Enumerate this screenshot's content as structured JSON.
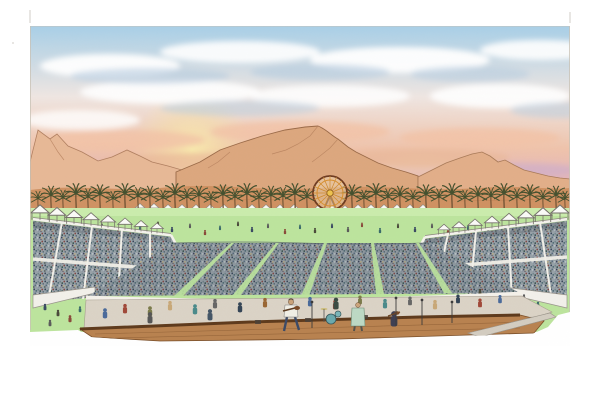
{
  "scene": {
    "description": "Hand-drawn colored-pencil rendering of a desert music festival at sunset: mountain backdrop under a pink and blue cloud-streaked sky, a line of palm trees with a ferris wheel, white-canopied grandstands flanking a huge crowd on a green field, and a stage with performers in the foreground."
  },
  "palette": {
    "paper": "#ffffff",
    "sky_top": "#a8cfe7",
    "sky_mid": "#efe6e2",
    "sky_pink": "#efc3ab",
    "sky_rose": "#dfb0bf",
    "sky_horizon": "#e8bca8",
    "sun_glow": "#f9eeae",
    "mountain_back": "#e7b896",
    "mountain_main": "#dca77e",
    "mountain_right": "#e2ae89",
    "mountain_line": "#9a6a48",
    "foothill": "#cd8f60",
    "palm": "#44502e",
    "palm_trunk": "#6f5233",
    "field": "#bce49d",
    "tent": "#fafaf7",
    "tent_line": "#75716a",
    "crowd_base": "#97a1a7",
    "wheel_rim": "#6e3b20",
    "wheel_spokes": "#cf8a2c",
    "wheel_hub": "#eec24e",
    "barrier": "#f4f1ea",
    "pit": "#dbd3c6",
    "stage_floor": "#b8824f",
    "stage_edge": "#5e3a1c",
    "border": "#c9c2b6"
  }
}
